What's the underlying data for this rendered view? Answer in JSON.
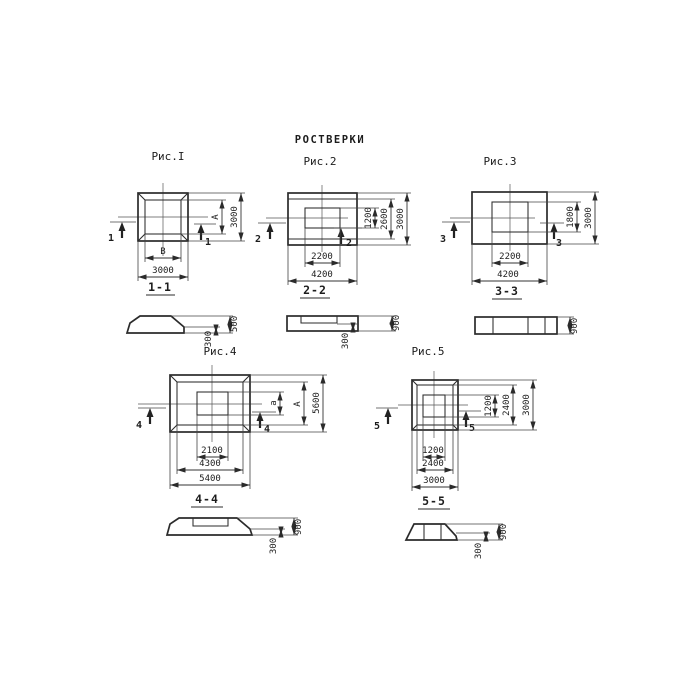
{
  "title": "РОСТВЕРКИ",
  "ink_color": "#2b2b2b",
  "figures": {
    "fig1": {
      "caption": "Рис.I",
      "cut": "1",
      "plan_dims": {
        "inner_w": "B",
        "outer_w": "3000",
        "inner_h": "A",
        "outer_h": "3000"
      },
      "section_title": "1-1",
      "section_dims": {
        "total": "500",
        "edge": "300"
      }
    },
    "fig2": {
      "caption": "Рис.2",
      "cut": "2",
      "plan_dims": {
        "inner_w": "2200",
        "outer_w": "4200",
        "inner_h": "1200",
        "mid_h": "2600",
        "outer_h": "3000"
      },
      "section_title": "2-2",
      "section_dims": {
        "total": "900",
        "edge": "300"
      }
    },
    "fig3": {
      "caption": "Рис.3",
      "cut": "3",
      "plan_dims": {
        "inner_w": "2200",
        "outer_w": "4200",
        "inner_h": "1800",
        "outer_h": "3000"
      },
      "section_title": "3-3",
      "section_dims": {
        "total": "900"
      }
    },
    "fig4": {
      "caption": "Рис.4",
      "cut": "4",
      "plan_dims": {
        "inner_w": "2100",
        "mid_w": "4300",
        "outer_w": "5400",
        "inner_h": "a",
        "mid_h": "A",
        "outer_h": "5600"
      },
      "section_title": "4-4",
      "section_dims": {
        "total": "900",
        "edge": "300"
      }
    },
    "fig5": {
      "caption": "Рис.5",
      "cut": "5",
      "plan_dims": {
        "inner_w": "1200",
        "mid_w": "2400",
        "outer_w": "3000",
        "inner_h": "1200",
        "mid_h": "2400",
        "outer_h": "3000"
      },
      "section_title": "5-5",
      "section_dims": {
        "total": "900",
        "edge": "300"
      }
    }
  }
}
